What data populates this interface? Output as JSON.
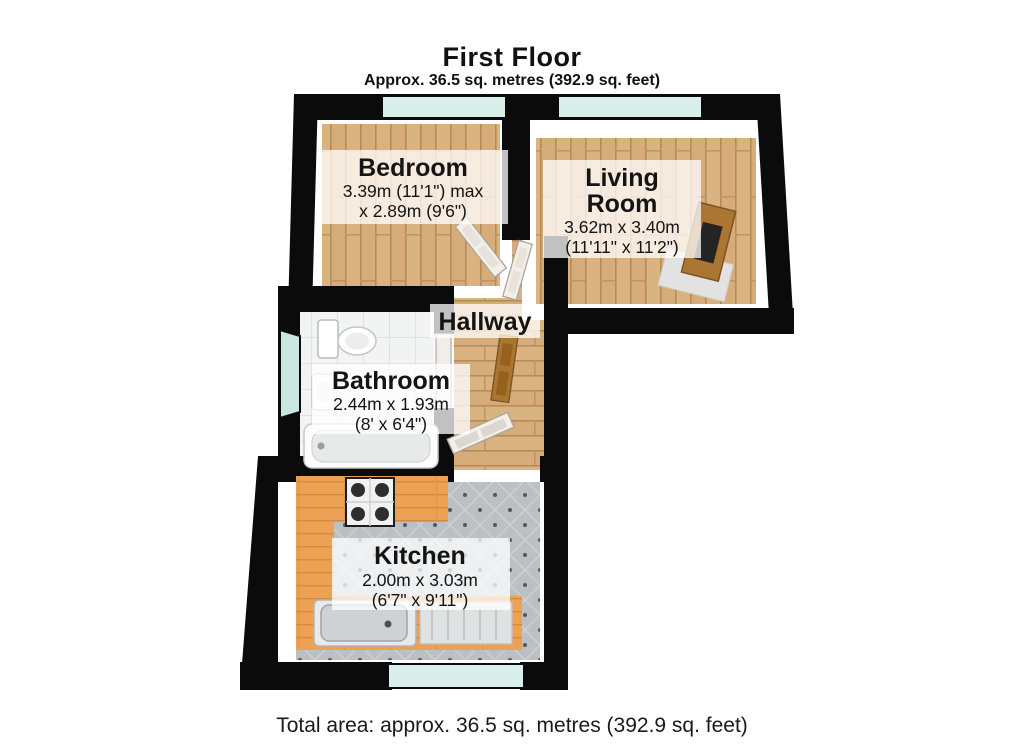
{
  "header": {
    "title": "First Floor",
    "subtitle": "Approx. 36.5 sq. metres (392.9 sq. feet)"
  },
  "footer": {
    "total_area": "Total area: approx. 36.5 sq. metres (392.9 sq. feet)"
  },
  "rooms": {
    "bedroom": {
      "name": "Bedroom",
      "dim1": "3.39m (11'1\") max",
      "dim2": "x 2.89m (9'6\")"
    },
    "living": {
      "name1": "Living",
      "name2": "Room",
      "dim1": "3.62m x 3.40m",
      "dim2": "(11'11\" x 11'2\")"
    },
    "hallway": {
      "name": "Hallway"
    },
    "bathroom": {
      "name": "Bathroom",
      "dim1": "2.44m x 1.93m",
      "dim2": "(8' x 6'4\")"
    },
    "kitchen": {
      "name": "Kitchen",
      "dim1": "2.00m x 3.03m",
      "dim2": "(6'7\" x 9'11\")"
    }
  },
  "colors": {
    "wall": "#0b0b0b",
    "wood_floor": "#d5ac7a",
    "wood_line": "#b68b58",
    "counter": "#eca155",
    "kitchen_tile": "#bcc0c3",
    "bath_tile": "#f2f3f3",
    "window_glass": "#d9efeb",
    "door_wood": "#a9762f",
    "label_bg": "rgba(255,255,255,0.75)"
  }
}
